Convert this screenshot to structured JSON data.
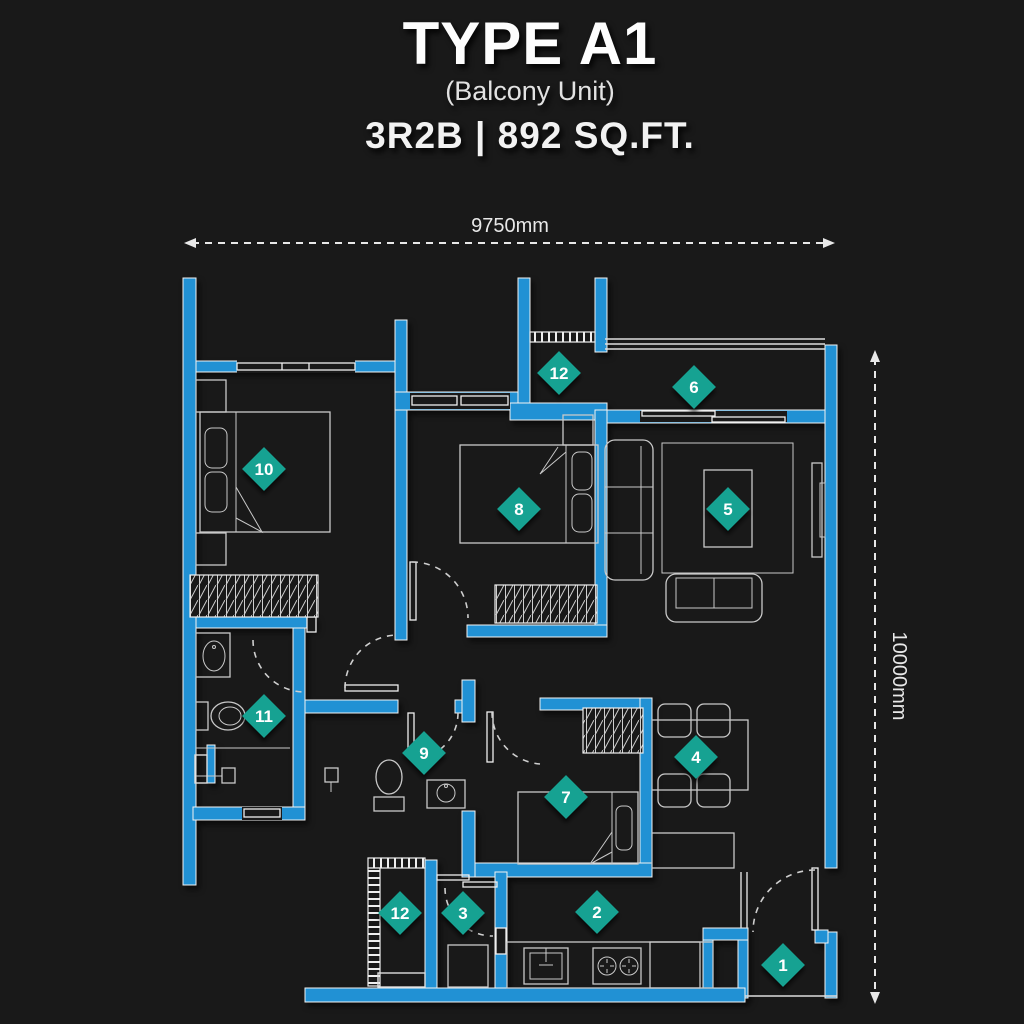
{
  "header": {
    "title": "TYPE A1",
    "subtitle": "(Balcony Unit)",
    "spec": "3R2B | 892 SQ.FT."
  },
  "dimensions": {
    "width": "9750mm",
    "height": "10000mm"
  },
  "markers": [
    {
      "label": "1",
      "x": 783,
      "y": 965
    },
    {
      "label": "2",
      "x": 597,
      "y": 912
    },
    {
      "label": "3",
      "x": 463,
      "y": 913
    },
    {
      "label": "4",
      "x": 696,
      "y": 757
    },
    {
      "label": "5",
      "x": 728,
      "y": 509
    },
    {
      "label": "6",
      "x": 694,
      "y": 387
    },
    {
      "label": "7",
      "x": 566,
      "y": 797
    },
    {
      "label": "8",
      "x": 519,
      "y": 509
    },
    {
      "label": "9",
      "x": 424,
      "y": 753
    },
    {
      "label": "10",
      "x": 264,
      "y": 469
    },
    {
      "label": "11",
      "x": 264,
      "y": 716
    },
    {
      "label": "12",
      "x": 559,
      "y": 373
    },
    {
      "label": "12",
      "x": 400,
      "y": 913
    }
  ],
  "colors": {
    "background": "#191919",
    "wall": "#2191d4",
    "marker": "#16a292",
    "line": "#e8e8e8",
    "furniture": "#c9c9c9"
  }
}
